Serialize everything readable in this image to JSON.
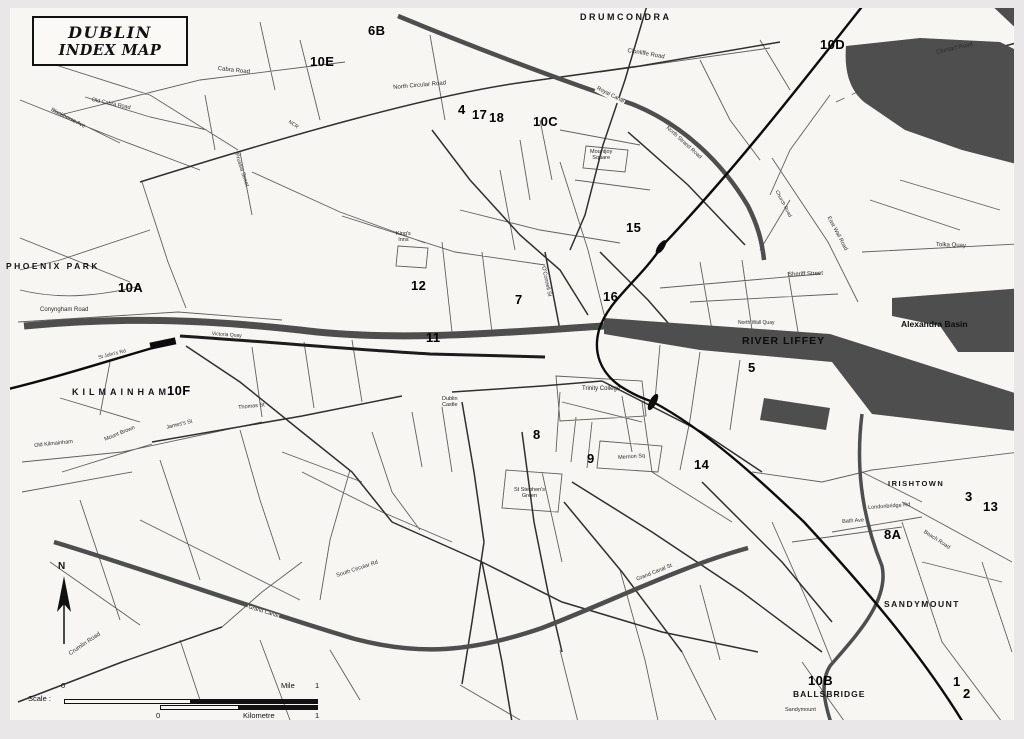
{
  "title": {
    "line1": "DUBLIN",
    "line2": "INDEX MAP"
  },
  "compass": {
    "north_label": "N"
  },
  "scalebar": {
    "label": "Scale :",
    "mile_zero": "0",
    "mile_label": "Mile",
    "mile_one": "1",
    "km_zero": "0",
    "km_label": "Kilometre",
    "km_one": "1"
  },
  "districts": [
    {
      "name": "DRUMCONDRA"
    },
    {
      "name": "PHOENIX PARK"
    },
    {
      "name": "KILMAINHAM"
    },
    {
      "name": "IRISHTOWN"
    },
    {
      "name": "SANDYMOUNT"
    },
    {
      "name": "BALLSBRIDGE"
    }
  ],
  "waterways": [
    {
      "name": "RIVER LIFFEY"
    },
    {
      "name": "Alexandra Basin"
    },
    {
      "name": "Royal Canal"
    },
    {
      "name": "Grand Canal"
    }
  ],
  "index_refs": [
    "6B",
    "10E",
    "10D",
    "4",
    "17",
    "18",
    "10C",
    "10A",
    "15",
    "12",
    "7",
    "16",
    "11",
    "10F",
    "5",
    "8",
    "9",
    "14",
    "3",
    "13",
    "8A",
    "10B",
    "1",
    "2"
  ],
  "places": [
    {
      "name": "Trinity College"
    },
    {
      "name": "Dublin\nCastle"
    },
    {
      "name": "St Stephen's\nGreen"
    },
    {
      "name": "Mountjoy\nSquare"
    },
    {
      "name": "King's\nInns"
    },
    {
      "name": "Merrion Sq"
    }
  ],
  "roads": [
    "Cabra Road",
    "Old Cabra Road",
    "Blackhorse Ave",
    "Prussia Street",
    "North Circular Road",
    "Clonliffe Road",
    "Clontarf Road",
    "North Strand Road",
    "East Wall Road",
    "Church Road",
    "Tolka Quay",
    "Sheriff Street",
    "North Wall Quay",
    "Conyngham Road",
    "St John's Rd",
    "Victoria Quay",
    "Old Kilmainham",
    "Mount Brown",
    "Thomas St",
    "James's St",
    "O'Connell St",
    "Crumlin Road",
    "South Circular Rd",
    "Grand Canal St",
    "Bath Ave",
    "Londonbridge Rd",
    "Beach Road",
    "Sandymount",
    "NCR"
  ],
  "colors": {
    "paper": "#f8f6f3",
    "water": "#4e4e4e",
    "rail": "#0c0c0c",
    "frame": "#e9e7e8"
  }
}
